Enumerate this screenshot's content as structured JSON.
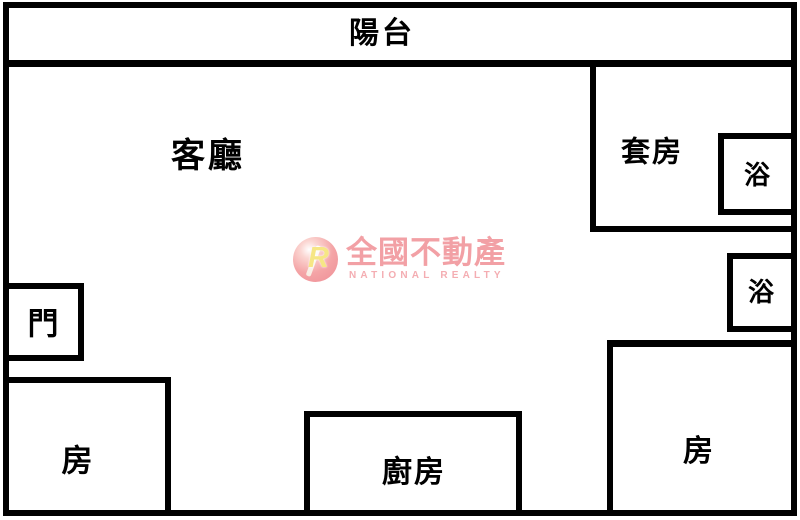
{
  "floorplan": {
    "rooms": {
      "balcony": "陽台",
      "living_room": "客廳",
      "suite": "套房",
      "suite_bath": "浴",
      "hall_bath": "浴",
      "entry_door": "門",
      "bedroom_left": "房",
      "kitchen": "廚房",
      "bedroom_right": "房"
    }
  },
  "watermark": {
    "monogram": "R",
    "brand_name": "全國不動產",
    "brand_name_en": "NATIONAL REALTY",
    "brand_color": "#f2a0a5"
  },
  "colors": {
    "wall": "#000000",
    "background": "#ffffff",
    "label": "#000000"
  }
}
